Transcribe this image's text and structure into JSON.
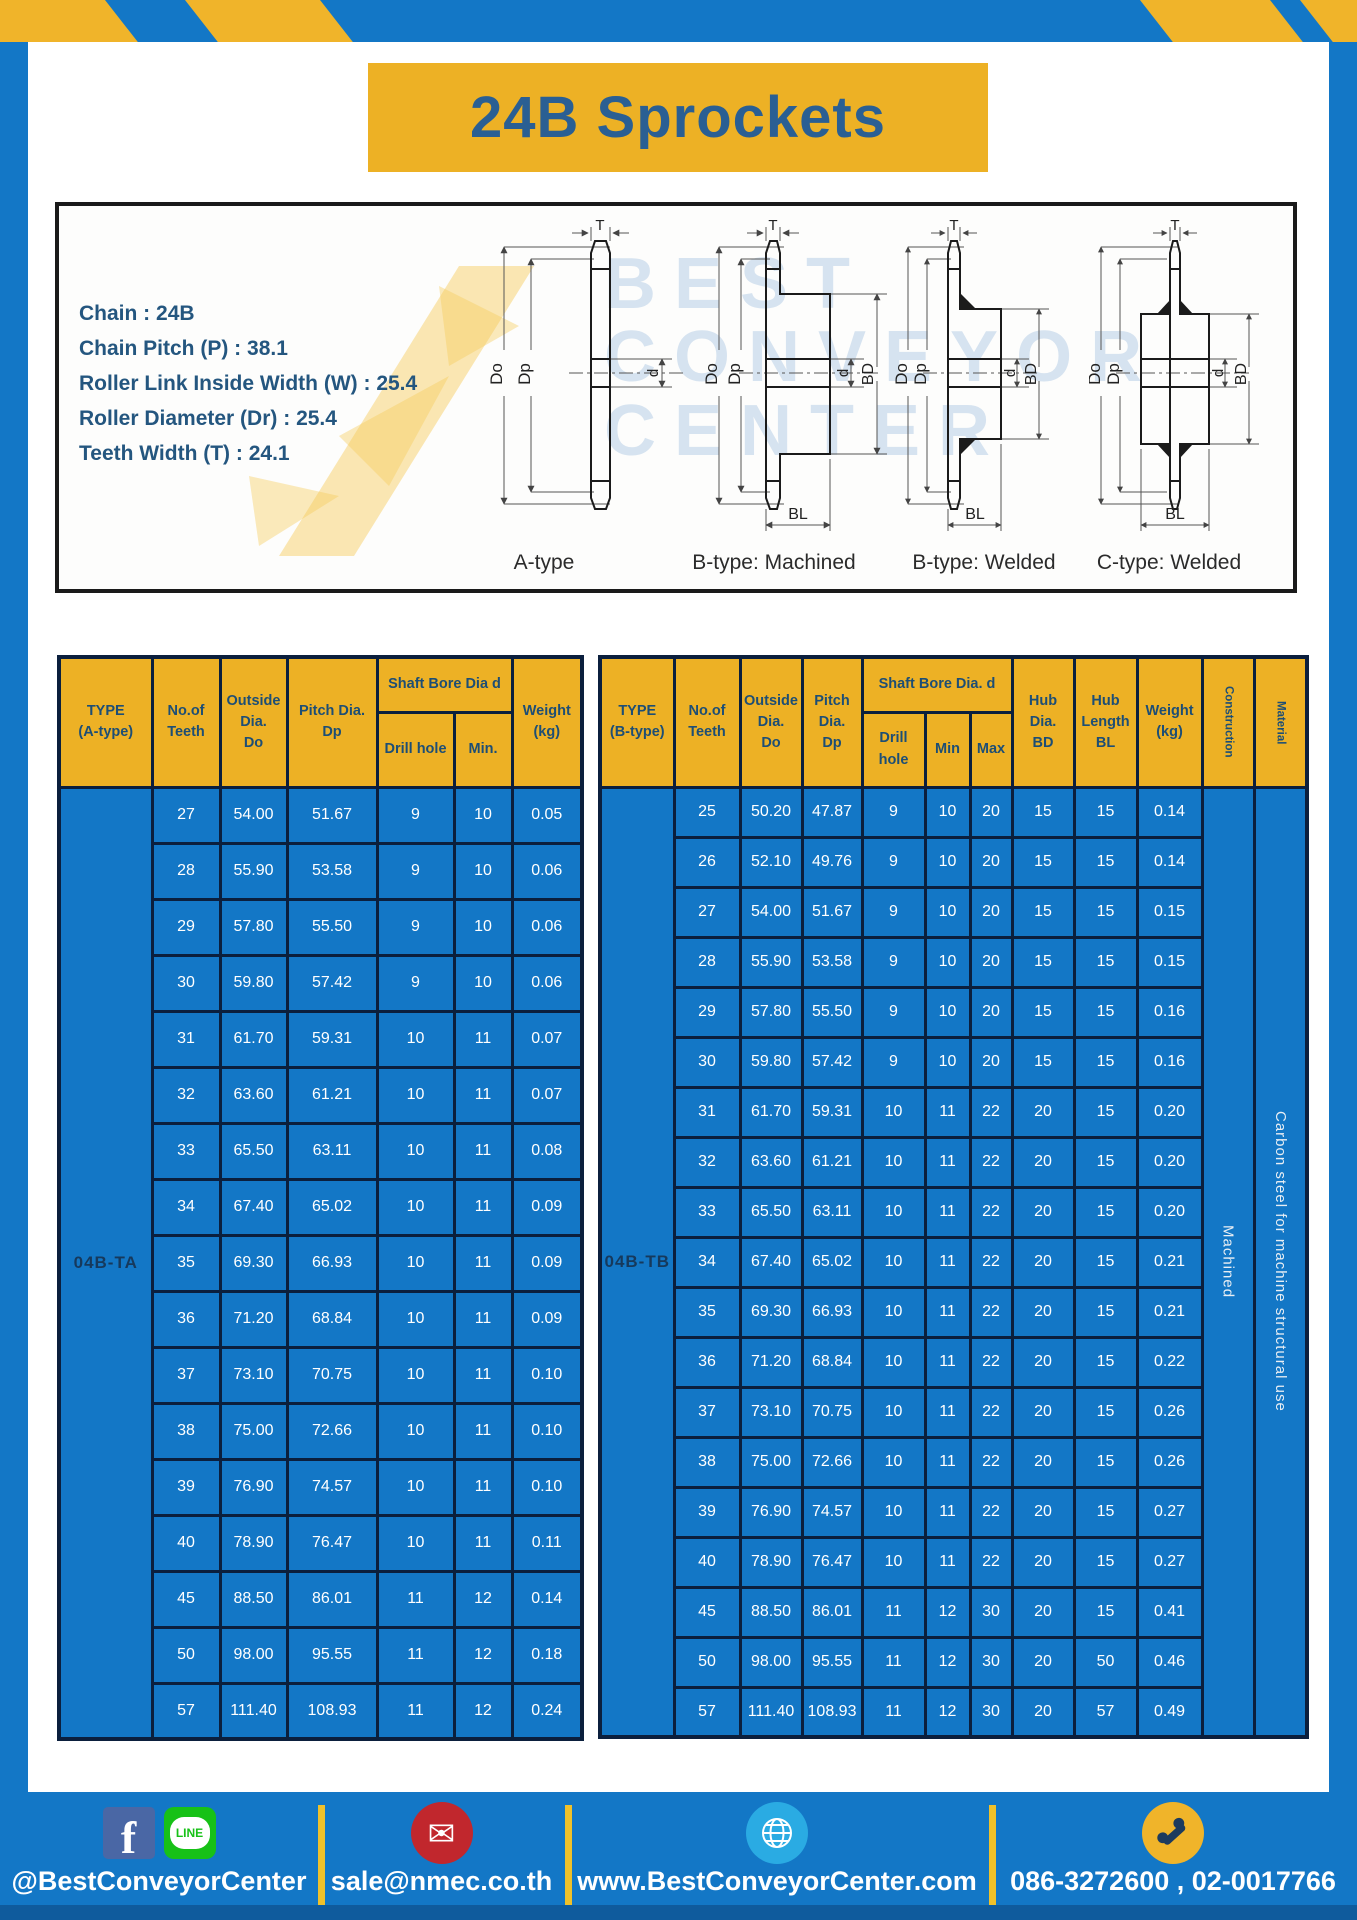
{
  "colors": {
    "brand_blue": "#1377c6",
    "brand_yellow": "#edb125",
    "navy_text": "#24567f",
    "table_border": "#0b1f3d",
    "facebook_blue": "#4a67a5",
    "line_green": "#17c117",
    "mail_red": "#c1272d",
    "globe_blue": "#2aabe3",
    "phone_yellow": "#f0b42a"
  },
  "header": {
    "title": "24B Sprockets"
  },
  "specs": {
    "lines": [
      {
        "label": "Chain",
        "value": "24B"
      },
      {
        "label": "Chain Pitch (P)",
        "value": "38.1"
      },
      {
        "label": "Roller Link Inside Width (W)",
        "value": "25.4"
      },
      {
        "label": "Roller Diameter (Dr)",
        "value": "25.4"
      },
      {
        "label": "Teeth Width (T)",
        "value": "24.1"
      }
    ]
  },
  "diagram": {
    "labels": [
      "A-type",
      "B-type: Machined",
      "B-type: Welded",
      "C-type: Welded"
    ],
    "dims": {
      "t": "T",
      "do": "Do",
      "dp": "Dp",
      "d": "d",
      "bd": "BD",
      "bl": "BL"
    },
    "watermark": [
      "BEST",
      "CONVEYOR",
      "CENTER"
    ]
  },
  "table_a": {
    "type_label": "04B-TA",
    "headers": {
      "type": "TYPE\n(A-type)",
      "teeth": "No.of\nTeeth",
      "outside": "Outside\nDia.\nDo",
      "pitch": "Pitch Dia.\nDp",
      "shaft_group": "Shaft Bore Dia d",
      "drill": "Drill hole",
      "min": "Min.",
      "weight": "Weight\n(kg)"
    },
    "rows": [
      [
        "27",
        "54.00",
        "51.67",
        "9",
        "10",
        "0.05"
      ],
      [
        "28",
        "55.90",
        "53.58",
        "9",
        "10",
        "0.06"
      ],
      [
        "29",
        "57.80",
        "55.50",
        "9",
        "10",
        "0.06"
      ],
      [
        "30",
        "59.80",
        "57.42",
        "9",
        "10",
        "0.06"
      ],
      [
        "31",
        "61.70",
        "59.31",
        "10",
        "11",
        "0.07"
      ],
      [
        "32",
        "63.60",
        "61.21",
        "10",
        "11",
        "0.07"
      ],
      [
        "33",
        "65.50",
        "63.11",
        "10",
        "11",
        "0.08"
      ],
      [
        "34",
        "67.40",
        "65.02",
        "10",
        "11",
        "0.09"
      ],
      [
        "35",
        "69.30",
        "66.93",
        "10",
        "11",
        "0.09"
      ],
      [
        "36",
        "71.20",
        "68.84",
        "10",
        "11",
        "0.09"
      ],
      [
        "37",
        "73.10",
        "70.75",
        "10",
        "11",
        "0.10"
      ],
      [
        "38",
        "75.00",
        "72.66",
        "10",
        "11",
        "0.10"
      ],
      [
        "39",
        "76.90",
        "74.57",
        "10",
        "11",
        "0.10"
      ],
      [
        "40",
        "78.90",
        "76.47",
        "10",
        "11",
        "0.11"
      ],
      [
        "45",
        "88.50",
        "86.01",
        "11",
        "12",
        "0.14"
      ],
      [
        "50",
        "98.00",
        "95.55",
        "11",
        "12",
        "0.18"
      ],
      [
        "57",
        "111.40",
        "108.93",
        "11",
        "12",
        "0.24"
      ]
    ]
  },
  "table_b": {
    "type_label": "04B-TB",
    "headers": {
      "type": "TYPE\n(B-type)",
      "teeth": "No.of\nTeeth",
      "outside": "Outside\nDia.\nDo",
      "pitch": "Pitch\nDia.\nDp",
      "shaft_group": "Shaft Bore Dia. d",
      "drill": "Drill hole",
      "min": "Min",
      "max": "Max",
      "hub_dia": "Hub\nDia.\nBD",
      "hub_len": "Hub\nLength\nBL",
      "weight": "Weight\n(kg)",
      "construction": "Construction",
      "material": "Material"
    },
    "construction_value": "Machined",
    "material_value": "Carbon steel for machine structural use",
    "rows": [
      [
        "25",
        "50.20",
        "47.87",
        "9",
        "10",
        "20",
        "15",
        "15",
        "0.14"
      ],
      [
        "26",
        "52.10",
        "49.76",
        "9",
        "10",
        "20",
        "15",
        "15",
        "0.14"
      ],
      [
        "27",
        "54.00",
        "51.67",
        "9",
        "10",
        "20",
        "15",
        "15",
        "0.15"
      ],
      [
        "28",
        "55.90",
        "53.58",
        "9",
        "10",
        "20",
        "15",
        "15",
        "0.15"
      ],
      [
        "29",
        "57.80",
        "55.50",
        "9",
        "10",
        "20",
        "15",
        "15",
        "0.16"
      ],
      [
        "30",
        "59.80",
        "57.42",
        "9",
        "10",
        "20",
        "15",
        "15",
        "0.16"
      ],
      [
        "31",
        "61.70",
        "59.31",
        "10",
        "11",
        "22",
        "20",
        "15",
        "0.20"
      ],
      [
        "32",
        "63.60",
        "61.21",
        "10",
        "11",
        "22",
        "20",
        "15",
        "0.20"
      ],
      [
        "33",
        "65.50",
        "63.11",
        "10",
        "11",
        "22",
        "20",
        "15",
        "0.20"
      ],
      [
        "34",
        "67.40",
        "65.02",
        "10",
        "11",
        "22",
        "20",
        "15",
        "0.21"
      ],
      [
        "35",
        "69.30",
        "66.93",
        "10",
        "11",
        "22",
        "20",
        "15",
        "0.21"
      ],
      [
        "36",
        "71.20",
        "68.84",
        "10",
        "11",
        "22",
        "20",
        "15",
        "0.22"
      ],
      [
        "37",
        "73.10",
        "70.75",
        "10",
        "11",
        "22",
        "20",
        "15",
        "0.26"
      ],
      [
        "38",
        "75.00",
        "72.66",
        "10",
        "11",
        "22",
        "20",
        "15",
        "0.26"
      ],
      [
        "39",
        "76.90",
        "74.57",
        "10",
        "11",
        "22",
        "20",
        "15",
        "0.27"
      ],
      [
        "40",
        "78.90",
        "76.47",
        "10",
        "11",
        "22",
        "20",
        "15",
        "0.27"
      ],
      [
        "45",
        "88.50",
        "86.01",
        "11",
        "12",
        "30",
        "20",
        "15",
        "0.41"
      ],
      [
        "50",
        "98.00",
        "95.55",
        "11",
        "12",
        "30",
        "20",
        "50",
        "0.46"
      ],
      [
        "57",
        "111.40",
        "108.93",
        "11",
        "12",
        "30",
        "20",
        "57",
        "0.49"
      ]
    ]
  },
  "footer": {
    "social": "@BestConveyorCenter",
    "email": "sale@nmec.co.th",
    "website": "www.BestConveyorCenter.com",
    "phone": "086-3272600 , 02-0017766"
  }
}
